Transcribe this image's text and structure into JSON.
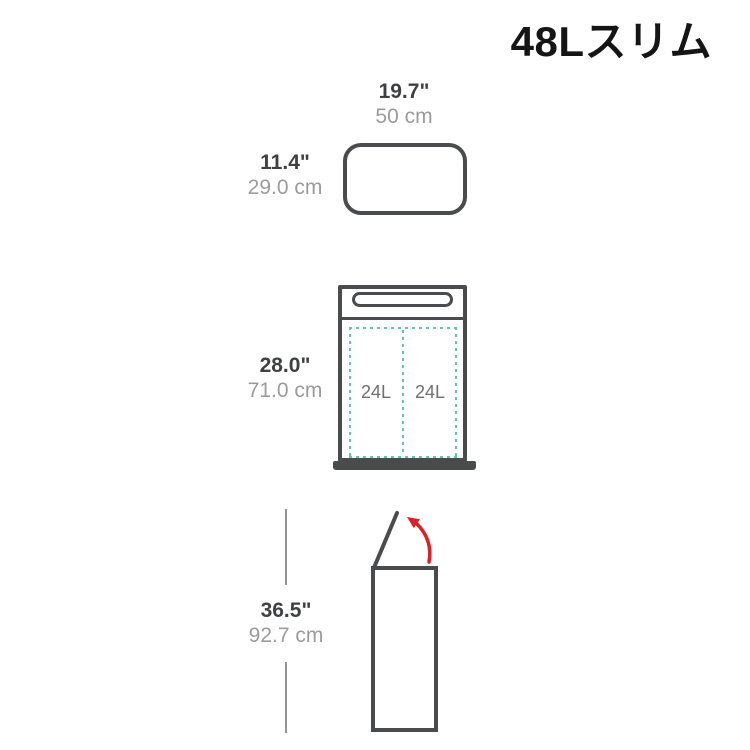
{
  "title": "48Lスリム",
  "colors": {
    "outline": "#4a4b4d",
    "text-dark": "#3f4042",
    "text-gray": "#9a9b9d",
    "capacity": "#6e6f71",
    "teal": "#66c2b2",
    "red": "#da2128",
    "dimline": "#939496"
  },
  "views": {
    "top": {
      "width": {
        "in": "19.7\"",
        "cm": "50 cm"
      },
      "depth": {
        "in": "11.4\"",
        "cm": "29.0 cm"
      }
    },
    "front": {
      "height": {
        "in": "28.0\"",
        "cm": "71.0 cm"
      },
      "buckets": [
        {
          "capacity": "24L"
        },
        {
          "capacity": "24L"
        }
      ]
    },
    "side": {
      "height": {
        "in": "36.5\"",
        "cm": "92.7 cm"
      }
    }
  }
}
